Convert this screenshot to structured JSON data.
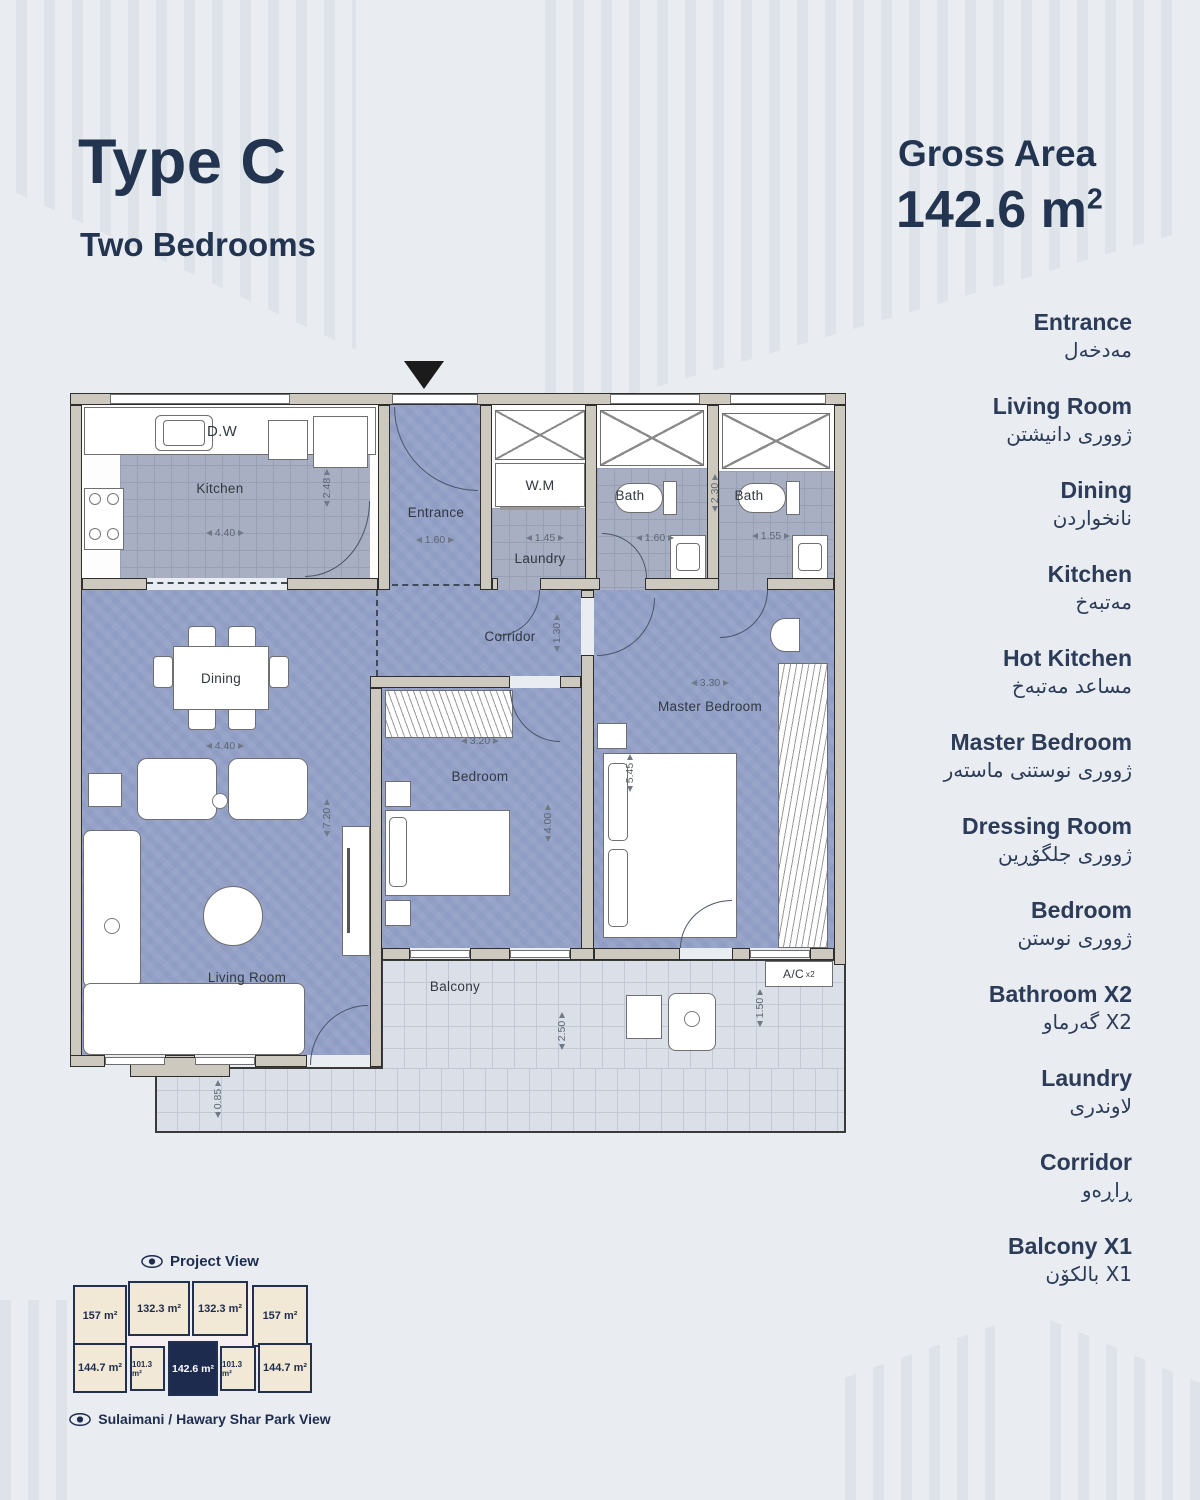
{
  "header": {
    "title": "Type C",
    "subtitle": "Two Bedrooms",
    "gross_area_label": "Gross Area",
    "gross_area_value": "142.6 m",
    "gross_area_sup": "2"
  },
  "legend": {
    "items": [
      {
        "en": "Entrance",
        "ar": "مەدخەل"
      },
      {
        "en": "Living Room",
        "ar": "ژووری دانیشتن"
      },
      {
        "en": "Dining",
        "ar": "نانخواردن"
      },
      {
        "en": "Kitchen",
        "ar": "مەتبەخ"
      },
      {
        "en": "Hot Kitchen",
        "ar": "مساعد مەتبەخ"
      },
      {
        "en": "Master Bedroom",
        "ar": "ژووری نوستنی ماستەر"
      },
      {
        "en": "Dressing Room",
        "ar": "ژووری جلگۆڕین"
      },
      {
        "en": "Bedroom",
        "ar": "ژووری نوستن"
      },
      {
        "en": "Bathroom X2",
        "ar": "X2 گەرماو"
      },
      {
        "en": "Laundry",
        "ar": "لاوندری"
      },
      {
        "en": "Corridor",
        "ar": "ڕاڕەو"
      },
      {
        "en": "Balcony X1",
        "ar": "X1 بالکۆن"
      }
    ]
  },
  "plan": {
    "rooms": {
      "kitchen": "Kitchen",
      "dw": "D.W",
      "entrance": "Entrance",
      "wm": "W.M",
      "laundry": "Laundry",
      "bath": "Bath",
      "corridor": "Corridor",
      "dining": "Dining",
      "living": "Living Room",
      "bedroom": "Bedroom",
      "master": "Master Bedroom",
      "balcony": "Balcony",
      "ac": "A/C",
      "ac_mult": "x2"
    },
    "dims": {
      "kitchen_w": "4.40",
      "kitchen_h": "2.48",
      "entrance_w": "1.60",
      "laundry_w": "1.45",
      "bath1_w": "1.60",
      "bath2_w": "1.55",
      "bath2_h": "2.30",
      "corridor_h": "1.30",
      "dining_w": "4.40",
      "living_h": "7.20",
      "bedroom_w": "3.20",
      "bedroom_h": "4.00",
      "master_w": "3.30",
      "master_h": "5.45",
      "balcony_h": "2.50",
      "balcony_side_h": "1.50",
      "balcony_bottom_h": "0.85"
    }
  },
  "project": {
    "view_label": "Project View",
    "park_label": "Sulaimani / Hawary Shar Park View",
    "units_top": [
      "157 m²",
      "132.3 m²",
      "132.3 m²",
      "157 m²"
    ],
    "units_bottom": [
      "144.7 m²",
      "101.3 m²",
      "142.6 m²",
      "101.3 m²",
      "144.7 m²"
    ],
    "highlighted_unit": "142.6 m²"
  },
  "colors": {
    "background": "#e9edf1",
    "navy_text": "#22344f",
    "room_fill": "#8f9cc4",
    "tile_fill": "#a8afc2",
    "balcony_fill": "#dbdfe8",
    "wall_fill": "#cdc9be",
    "unit_beige": "#f1e8d5",
    "unit_highlight": "#1c2b4e"
  }
}
